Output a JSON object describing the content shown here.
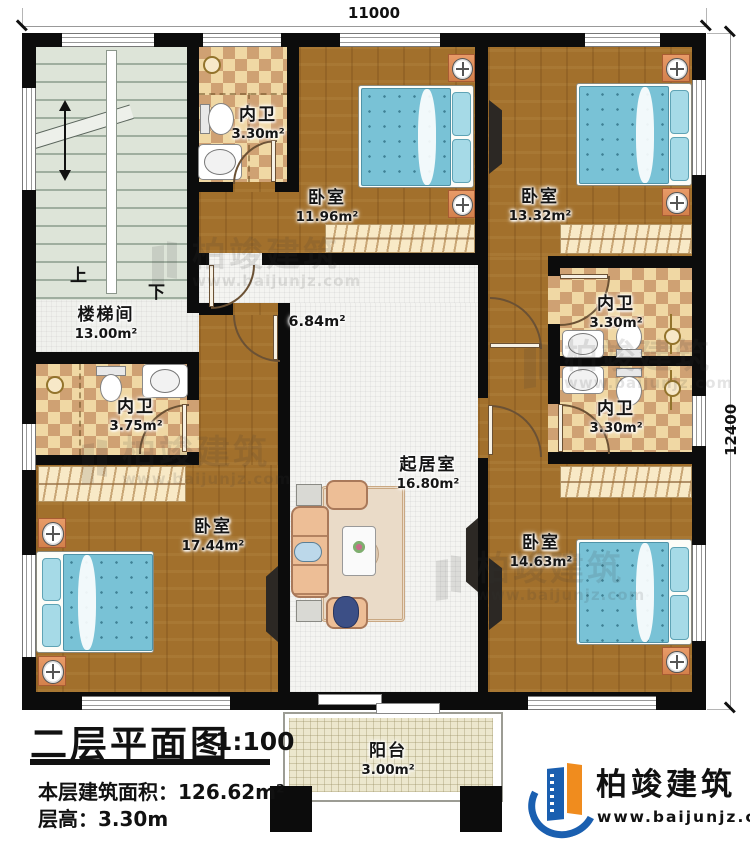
{
  "dimensions": {
    "top": "11000",
    "right": "12400"
  },
  "rooms": {
    "bath_top_left": {
      "name": "内卫",
      "area": "3.30m²"
    },
    "bedroom_top_mid": {
      "name": "卧室",
      "area": "11.96m²"
    },
    "bedroom_top_right": {
      "name": "卧室",
      "area": "13.32m²"
    },
    "stairwell": {
      "name": "楼梯间",
      "area": "13.00m²"
    },
    "hallway": {
      "area": "6.84m²"
    },
    "bath_left": {
      "name": "内卫",
      "area": "3.75m²"
    },
    "bath_right_upper": {
      "name": "内卫",
      "area": "3.30m²"
    },
    "bath_right_lower": {
      "name": "内卫",
      "area": "3.30m²"
    },
    "living": {
      "name": "起居室",
      "area": "16.80m²"
    },
    "bedroom_bottom_left": {
      "name": "卧室",
      "area": "17.44m²"
    },
    "bedroom_bottom_right": {
      "name": "卧室",
      "area": "14.63m²"
    },
    "balcony": {
      "name": "阳台",
      "area": "3.00m²"
    }
  },
  "stairs": {
    "up": "上",
    "down": "下"
  },
  "title_block": {
    "title": "二层平面图",
    "scale": "1:100",
    "area_label": "本层建筑面积：",
    "area_value": "126.62m²",
    "height_label": "层高：",
    "height_value": "3.30m"
  },
  "branding": {
    "logo_text": "柏竣建筑",
    "logo_url": "www.baijunjz.com"
  },
  "watermark": {
    "text": "柏竣建筑",
    "url": "www.baijunjz.com"
  },
  "colors": {
    "wall": "#0c0c0c",
    "wood_floor": "#a2702c",
    "tile_light": "#f0d8a4",
    "tile_dark": "#cfa173",
    "stair_floor": "#dde4d8",
    "balcony_floor": "#ece7cd",
    "bed_blue": "#79c2d6",
    "accent_orange": "#f08c1e",
    "accent_blue": "#1a5fb0"
  }
}
